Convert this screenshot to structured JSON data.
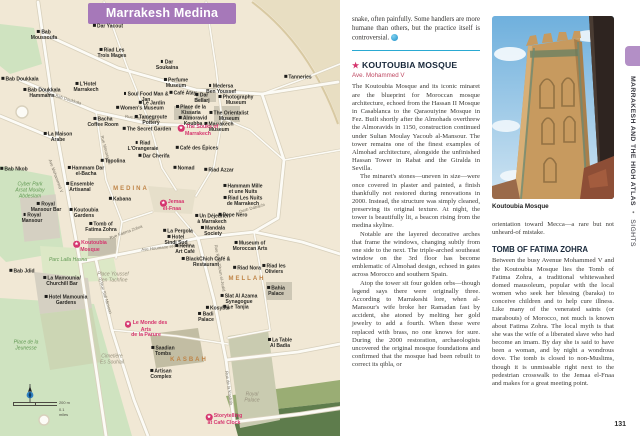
{
  "colors": {
    "banner_purple": "#a678b9",
    "tab_purple": "#b38fc6",
    "highlight_pink": "#d5356e",
    "divider_blue": "#2aa9d2",
    "district_orange": "#bf8447",
    "map_cream": "#f1e8d5",
    "park_green": "#cfe3c0"
  },
  "map": {
    "title": "Marrakesh Medina",
    "scale": {
      "metric": "200 m",
      "imperial": "0.1 miles"
    },
    "pois": [
      {
        "x": 108,
        "y": 27,
        "label": "Dar Yacout"
      },
      {
        "x": 44,
        "y": 36,
        "label": "Bab\nMoussoufa"
      },
      {
        "x": 112,
        "y": 54,
        "label": "Riad Les\nTrois Mages"
      },
      {
        "x": 167,
        "y": 66,
        "label": "Dar\nSoukaina"
      },
      {
        "x": 20,
        "y": 80,
        "label": "Bab Doukkala"
      },
      {
        "x": 42,
        "y": 94,
        "label": "Bab Doukkala\nHammams"
      },
      {
        "x": 86,
        "y": 88,
        "label": "L'Hotel\nMarrakech"
      },
      {
        "x": 176,
        "y": 84,
        "label": "Perfume\nMuseum"
      },
      {
        "x": 183,
        "y": 94,
        "label": "Café Atay"
      },
      {
        "x": 221,
        "y": 90,
        "label": "Medersa\nBen Youssef"
      },
      {
        "x": 202,
        "y": 99,
        "label": "Dar\nBellarj"
      },
      {
        "x": 236,
        "y": 101,
        "label": "Photography\nMuseum"
      },
      {
        "x": 298,
        "y": 78,
        "label": "Tanneries"
      },
      {
        "x": 229,
        "y": 117,
        "label": "The Orientalist\nMuseum"
      },
      {
        "x": 219,
        "y": 128,
        "label": "Marrakech\nMuseum"
      },
      {
        "x": 191,
        "y": 111,
        "label": "Place de la\nKissaria"
      },
      {
        "x": 193,
        "y": 122,
        "label": "Almoravid\nKoubba"
      },
      {
        "t": "hl",
        "x": 198,
        "y": 131,
        "label": "The Souks of\nMarrakech"
      },
      {
        "x": 146,
        "y": 98,
        "label": "Soul Food Man & Jan"
      },
      {
        "x": 152,
        "y": 104,
        "label": "Le Jardin"
      },
      {
        "x": 140,
        "y": 109,
        "label": "Women's Museum"
      },
      {
        "x": 151,
        "y": 121,
        "label": "Tamegroute\nPottery"
      },
      {
        "x": 147,
        "y": 130,
        "label": "The Secret Garden"
      },
      {
        "x": 103,
        "y": 123,
        "label": "Bacha\nCoffee Room"
      },
      {
        "x": 143,
        "y": 147,
        "label": "Riad\nL'Orangeraie"
      },
      {
        "x": 154,
        "y": 157,
        "label": "Dar Cherifa"
      },
      {
        "x": 197,
        "y": 149,
        "label": "Café des Épices"
      },
      {
        "x": 184,
        "y": 169,
        "label": "Nomad"
      },
      {
        "x": 219,
        "y": 171,
        "label": "Riad Azzar"
      },
      {
        "x": 243,
        "y": 190,
        "label": "Hammam Mille\net une Nuits"
      },
      {
        "x": 243,
        "y": 202,
        "label": "Riad Les Nuits\nde Marrakech"
      },
      {
        "t": "hl",
        "x": 172,
        "y": 206,
        "label": "Jemaa\nel-Fnaa"
      },
      {
        "x": 212,
        "y": 220,
        "label": "Un Déjeuner\nà Marrakech"
      },
      {
        "x": 233,
        "y": 216,
        "label": "Pepe Nero"
      },
      {
        "x": 213,
        "y": 232,
        "label": "Mandala\nSociety"
      },
      {
        "x": 250,
        "y": 247,
        "label": "Museum of\nMoroccan Arts"
      },
      {
        "x": 247,
        "y": 269,
        "label": "Riad Nora"
      },
      {
        "x": 274,
        "y": 270,
        "label": "Riad les\nOliviers"
      },
      {
        "x": 276,
        "y": 292,
        "label": "Bahia\nPalace"
      },
      {
        "x": 239,
        "y": 300,
        "label": "Slat Al Azama\nSynagogue"
      },
      {
        "x": 236,
        "y": 308,
        "label": "Le Tanjia"
      },
      {
        "x": 218,
        "y": 309,
        "label": "Kosybar"
      },
      {
        "x": 206,
        "y": 318,
        "label": "Badi\nPalace"
      },
      {
        "x": 178,
        "y": 232,
        "label": "La Pergola"
      },
      {
        "x": 176,
        "y": 241,
        "label": "Hotel\nSindi Sud"
      },
      {
        "x": 185,
        "y": 250,
        "label": "Henna\nArt Café"
      },
      {
        "x": 206,
        "y": 263,
        "label": "BlackChich Café &\nRestaurant"
      },
      {
        "t": "hl",
        "x": 146,
        "y": 330,
        "label": "Le Monde des Arts\nde la Parure"
      },
      {
        "x": 163,
        "y": 352,
        "label": "Saadian\nTombs"
      },
      {
        "x": 161,
        "y": 375,
        "label": "Artisan\nComplex"
      },
      {
        "t": "hl",
        "x": 224,
        "y": 420,
        "label": "Storytelling\nat Café Clock"
      },
      {
        "x": 280,
        "y": 344,
        "label": "La Table\nAl Badia"
      },
      {
        "t": "place",
        "x": 252,
        "y": 398,
        "label": "Royal\nPalace"
      },
      {
        "x": 101,
        "y": 228,
        "label": "Tomb of\nFatima Zohra"
      },
      {
        "t": "hl",
        "x": 90,
        "y": 247,
        "label": "Koutoubia\nMosque"
      },
      {
        "x": 84,
        "y": 214,
        "label": "Koutoubia\nGardens"
      },
      {
        "t": "area",
        "x": 68,
        "y": 261,
        "label": "Parc Lalla Hasna"
      },
      {
        "t": "place",
        "x": 113,
        "y": 278,
        "label": "Place Youssef\nBen Tachfine"
      },
      {
        "x": 22,
        "y": 272,
        "label": "Bab Jdid"
      },
      {
        "x": 62,
        "y": 282,
        "label": "La Mamounia/\nChurchill Bar"
      },
      {
        "x": 66,
        "y": 301,
        "label": "Hotel Mamounia\nGardens"
      },
      {
        "x": 14,
        "y": 170,
        "label": "Bab Nkob"
      },
      {
        "t": "area",
        "x": 30,
        "y": 191,
        "label": "Cyber Park\nArsat Moulay\nAbdeslam"
      },
      {
        "x": 58,
        "y": 138,
        "label": "La Maison\nArabe"
      },
      {
        "x": 86,
        "y": 172,
        "label": "Hammam Dar\nel-Bacha"
      },
      {
        "x": 80,
        "y": 188,
        "label": "Ensemble\nArtisanal"
      },
      {
        "x": 113,
        "y": 162,
        "label": "Topolina"
      },
      {
        "x": 120,
        "y": 200,
        "label": "Kabana"
      },
      {
        "x": 46,
        "y": 208,
        "label": "Royal\nMansour Bar"
      },
      {
        "x": 32,
        "y": 219,
        "label": "Royal\nMansour"
      },
      {
        "t": "area",
        "x": 26,
        "y": 346,
        "label": "Place de la\nJeunesse"
      },
      {
        "t": "place",
        "x": 112,
        "y": 360,
        "label": "Cimetière\nEs Souhail"
      },
      {
        "t": "district",
        "x": 131,
        "y": 189,
        "label": "MEDINA"
      },
      {
        "t": "district",
        "x": 247,
        "y": 279,
        "label": "MELLAH"
      },
      {
        "t": "district",
        "x": 189,
        "y": 360,
        "label": "KASBAH"
      }
    ],
    "streets": [
      {
        "label": "Rue Bab Doukkala",
        "x": 64,
        "y": 98,
        "r": 17
      },
      {
        "label": "Rue Dar el-Bacha",
        "x": 142,
        "y": 118,
        "r": 6
      },
      {
        "label": "Ave Mohammed V",
        "x": 56,
        "y": 176,
        "r": 70
      },
      {
        "label": "Rue Mouassine",
        "x": 106,
        "y": 150,
        "r": 75
      },
      {
        "label": "Rue Riad Zitoun el-Jedid",
        "x": 220,
        "y": 268,
        "r": 80
      },
      {
        "label": "Rue de la Kasbah",
        "x": 229,
        "y": 388,
        "r": 82
      },
      {
        "label": "Ave Houmane el-Fetouaki",
        "x": 166,
        "y": 247,
        "r": -6
      },
      {
        "label": "Rue Sidi Mimoun",
        "x": 106,
        "y": 298,
        "r": 73
      },
      {
        "label": "Derb Dabachi",
        "x": 252,
        "y": 208,
        "r": -16
      },
      {
        "label": "Rue Fatima Zohra",
        "x": 126,
        "y": 232,
        "r": -20
      }
    ]
  },
  "article": {
    "lead_end": "snake, often painfully. Some handlers are more humane than others, but the practice itself is controversial.",
    "koutoubia": {
      "star": "★",
      "title": "KOUTOUBIA MOSQUE",
      "address": "Ave. Mohammed V",
      "paragraphs": [
        "The Koutoubia Mosque and its iconic minaret are the blueprint for Moroccan mosque architecture, echoed from the Hassan II Mosque in Casablanca to the Qaraouiyine Mosque in Fez. Built shortly after the Almohads overthrew the Almoravids in 1150, construction continued under Sultan Moulay Yacoub al-Mansour. The tower remains one of the finest examples of Almohad architecture, alongside the unfinished Hassan Tower in Rabat and the Giralda in Sevilla.",
        "The minaret's stones—uneven in size—were once covered in plaster and painted, a finish thankfully not restored during renovations in 2000. Instead, the structure was simply cleaned, preserving its original texture. At night, the tower is beautifully lit, a beacon rising from the medina skyline.",
        "Notable are the layered decorative arches that frame the windows, changing subtly from one side to the next. The triple-arched southeast window on the 3rd floor has become emblematic of Almohad design, echoed in gates across Morocco and southern Spain.",
        "Atop the tower sit four golden orbs—though legend says there were originally three. According to Marrakeshi lore, when al-Mansour's wife broke her Ramadan fast by accident, she atoned by melting her gold jewelry to add a fourth. When these were replaced with brass, no one knows for sure. During the 2000 restoration, archaeologists uncovered the original mosque foundations and confirmed that the mosque had been rebuilt to correct its qibla, or"
      ]
    },
    "photo_caption": "Koutoubia Mosque",
    "col2_continuation": "orientation toward Mecca—a rare but not unheard-of mistake.",
    "fatima": {
      "title": "TOMB OF FATIMA ZOHRA",
      "paragraph": "Between the busy Avenue Mohammed V and the Koutoubia Mosque lies the Tomb of Fatima Zohra, a traditional whitewashed domed mausoleum, popular with the local women who seek her blessing (baraka) to conceive children and to help cure illness. Like many of the venerated saints (or marabouts) of Morocco, not much is known about Fatima Zohra. The local myth is that she was the wife of a liberated slave who had become an imam. By day she is said to have been a woman, and by night a wondrous dove. The tomb is closed to non-Muslims, though it is unmissable right next to the pedestrian crosswalk to the Jemaa el-Fnaa and makes for a great meeting point."
    },
    "sidebar": {
      "chapter": "MARRAKESH AND THE HIGH ATLAS",
      "divider": "•",
      "section": "SIGHTS"
    },
    "page_number": "131"
  }
}
